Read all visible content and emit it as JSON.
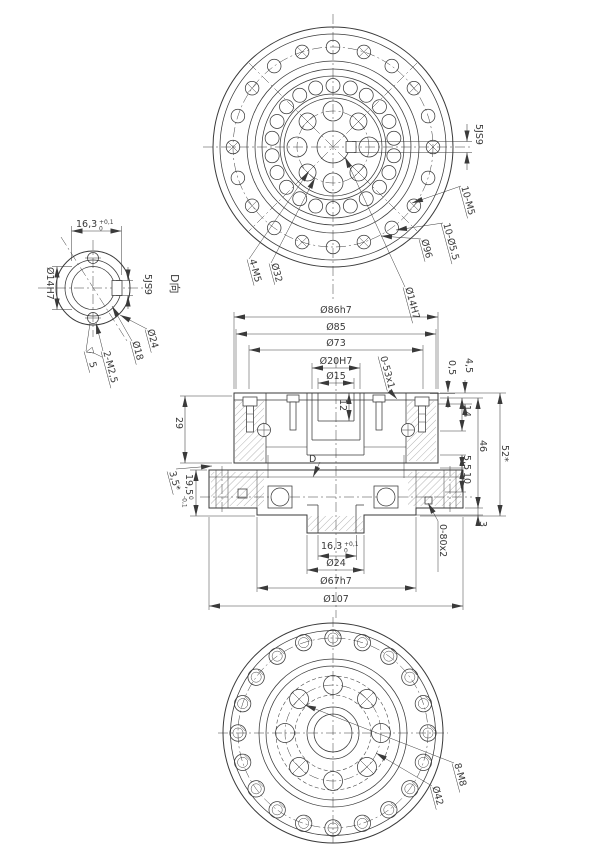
{
  "meta": {
    "background": "#ffffff",
    "ink_color": "#3a3a3a"
  },
  "top_view": {
    "labels": {
      "key_width": "5JS9",
      "outer_tapped": "10-M5",
      "outer_clearance": "10-Ø5.5",
      "bolt_circle": "Ø96",
      "center_bore": "Ø14H7",
      "inner_bolt_circle": "Ø32",
      "inner_tapped": "4-M5"
    }
  },
  "detail_view": {
    "title": "D向",
    "labels": {
      "key_length": "16,3",
      "key_length_sup": "+0,1",
      "key_length_sub": "0",
      "bore": "Ø14H7",
      "key_width": "5JS9",
      "outer_dia": "Ø24",
      "mid_dia": "Ø18",
      "tapped": "2-M2,5",
      "finish": "5"
    }
  },
  "section_view": {
    "labels": {
      "dia_86": "Ø86h7",
      "dia_85": "Ø85",
      "dia_73": "Ø73",
      "dia_20": "Ø20H7",
      "dia_15": "Ø15",
      "oring_top": "0-53x1",
      "step_05": "0,5",
      "step_45": "4,5",
      "depth_12": "12",
      "view_arrow": "D",
      "depth_14": "14",
      "height_46": "46",
      "height_52": "52*",
      "step_55": "5,5",
      "step_10": "10",
      "plate_3": "3",
      "oring_bottom": "0-80x2",
      "height_29": "29",
      "offset_35": "3,5*",
      "height_195": "19,5",
      "height_195_sup": "0",
      "height_195_sub": "-0,1",
      "key_length": "16,3",
      "key_length_sup": "+0,1",
      "key_length_sub": "0",
      "dia_24": "Ø24",
      "dia_67": "Ø67h7",
      "dia_107": "Ø107"
    }
  },
  "bottom_view": {
    "labels": {
      "tapped": "8-M8",
      "bolt_circle": "Ø42"
    }
  }
}
